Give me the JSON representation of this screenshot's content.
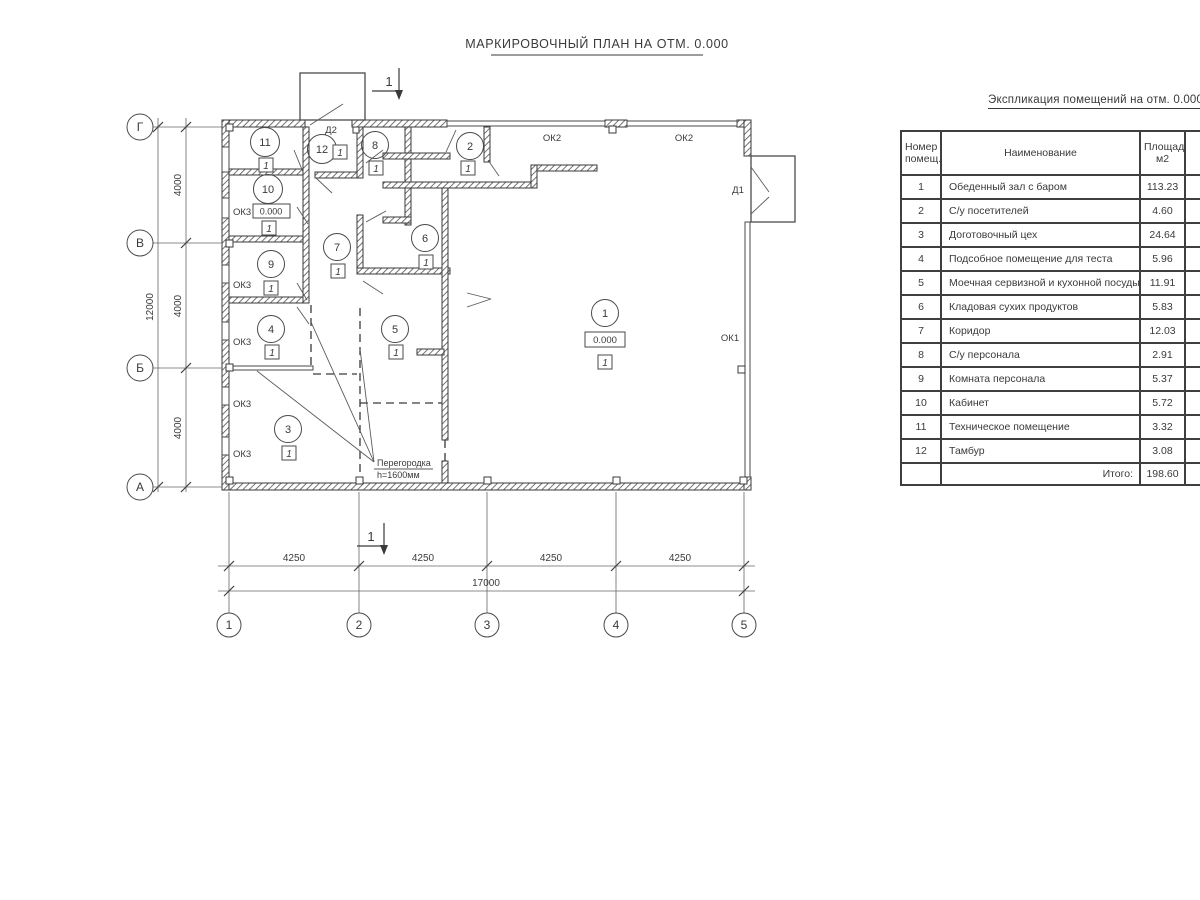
{
  "title": "МАРКИРОВОЧНЫЙ ПЛАН НА ОТМ. 0.000",
  "colors": {
    "line": "#3a3a3a",
    "thin_line": "#555555",
    "background": "#ffffff"
  },
  "plan": {
    "rooms": [
      "1",
      "2",
      "3",
      "4",
      "5",
      "6",
      "7",
      "8",
      "9",
      "10",
      "11",
      "12"
    ],
    "labels": {
      "ok1": "ОК1",
      "ok2": "ОК2",
      "ok3": "ОК3",
      "d1": "Д1",
      "d2": "Д2",
      "level": "0.000",
      "floor_mark": "1",
      "section": "1",
      "partition_line1": "Перегородка",
      "partition_line2": "h=1600мм"
    },
    "axes": {
      "cols": [
        "1",
        "2",
        "3",
        "4",
        "5"
      ],
      "rows": [
        "Г",
        "В",
        "Б",
        "А"
      ]
    },
    "dims": {
      "bay": "4250",
      "total_w": "17000",
      "row": "4000",
      "total_h": "12000"
    }
  },
  "table": {
    "title": "Экспликация помещений на отм. 0.000",
    "headers": {
      "num1": "Номер",
      "num2": "помещ.",
      "name": "Наименование",
      "area1": "Площадь,",
      "area2": "м2",
      "cat1": "Ка",
      "cat2": "по"
    },
    "rows": [
      {
        "n": "1",
        "name": "Обеденный зал с баром",
        "a": "113.23"
      },
      {
        "n": "2",
        "name": "С/у посетителей",
        "a": "4.60"
      },
      {
        "n": "3",
        "name": "Доготовочный цех",
        "a": "24.64"
      },
      {
        "n": "4",
        "name": "Подсобное помещение для теста",
        "a": "5.96"
      },
      {
        "n": "5",
        "name": "Моечная сервизной и кухонной посуды",
        "a": "11.91"
      },
      {
        "n": "6",
        "name": "Кладовая сухих продуктов",
        "a": "5.83"
      },
      {
        "n": "7",
        "name": "Коридор",
        "a": "12.03"
      },
      {
        "n": "8",
        "name": "С/у персонала",
        "a": "2.91"
      },
      {
        "n": "9",
        "name": "Комната персонала",
        "a": "5.37"
      },
      {
        "n": "10",
        "name": "Кабинет",
        "a": "5.72"
      },
      {
        "n": "11",
        "name": "Техническое помещение",
        "a": "3.32"
      },
      {
        "n": "12",
        "name": "Тамбур",
        "a": "3.08"
      }
    ],
    "total_label": "Итого:",
    "total_value": "198.60"
  }
}
